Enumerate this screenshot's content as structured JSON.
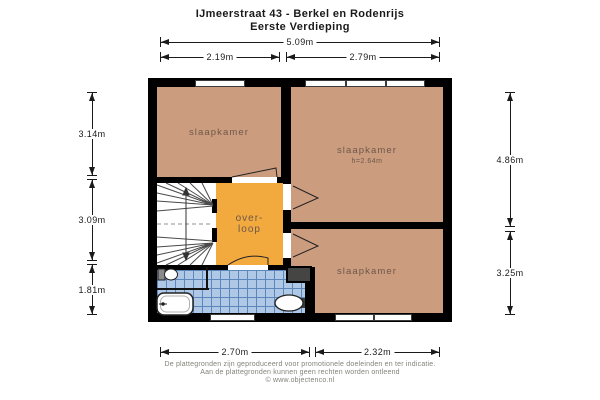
{
  "title": {
    "line1": "IJmeerstraat 43 - Berkel en Rodenrijs",
    "line2": "Eerste Verdieping"
  },
  "dims": {
    "top_total": "5.09m",
    "top_left": "2.19m",
    "top_right": "2.79m",
    "left_top": "3.14m",
    "left_mid": "3.09m",
    "left_bottom": "1.81m",
    "right_top": "4.86m",
    "right_bottom": "3.25m",
    "bottom_left": "2.70m",
    "bottom_right": "2.32m"
  },
  "rooms": {
    "bedroom_top_left": {
      "label": "slaapkamer"
    },
    "bedroom_top_right": {
      "label": "slaapkamer",
      "height_note": "h=2.64m"
    },
    "bedroom_bottom_right": {
      "label": "slaapkamer"
    },
    "landing": {
      "label_line1": "over-",
      "label_line2": "loop"
    }
  },
  "footer": {
    "line1": "De plattegronden zijn geproduceerd voor promotionele doeleinden en ter indicatie.",
    "line2": "Aan de plattegronden kunnen geen rechten worden ontleend",
    "line3": "© www.objectenco.nl"
  },
  "colors": {
    "wall": "#000000",
    "room": "#cc9c7e",
    "landing": "#f2a93e",
    "tile": "#aec8e6",
    "tile_line": "#5d86bd",
    "duct": "#454543",
    "accent_text": "#6d584b"
  }
}
